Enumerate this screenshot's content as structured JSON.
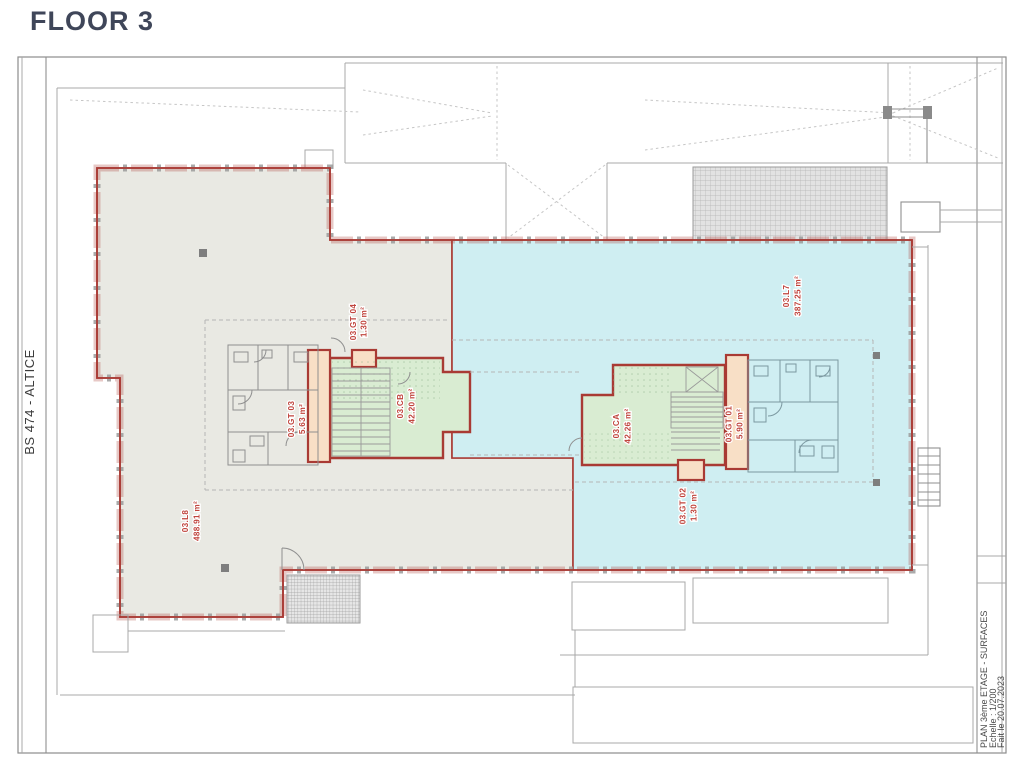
{
  "page_title": "FLOOR 3",
  "colors": {
    "title_color": "#3f4659",
    "facade_red": "#a93a34",
    "label_red": "#c0443d",
    "zone_beige": "#e9e9e3",
    "zone_blue": "#cfeef2",
    "zone_green": "#d9ecd2",
    "zone_peach": "#f8dfc6",
    "line_grey": "#a8a8a8",
    "bath_blue_line": "#7b98a0"
  },
  "left_titleblock": {
    "label": "BS 474 - ALTICE"
  },
  "right_titleblock": {
    "line1": "PLAN 3ème ETAGE - SURFACES",
    "line2": "Echelle : 1/200",
    "line3": "Fait le 20.07.2023"
  },
  "rooms": {
    "l8": {
      "code": "03.L8",
      "area": "488.91 m²"
    },
    "l7": {
      "code": "03.L7",
      "area": "387.25 m²"
    },
    "cb": {
      "code": "03.CB",
      "area": "42.20 m²"
    },
    "ca": {
      "code": "03.CA",
      "area": "42.26 m²"
    },
    "gt01": {
      "code": "03.GT 01",
      "area": "5.90 m²"
    },
    "gt02": {
      "code": "03.GT 02",
      "area": "1.30 m²"
    },
    "gt03": {
      "code": "03.GT 03",
      "area": "5.63 m²"
    },
    "gt04": {
      "code": "03.GT 04",
      "area": "1.30 m²"
    }
  }
}
